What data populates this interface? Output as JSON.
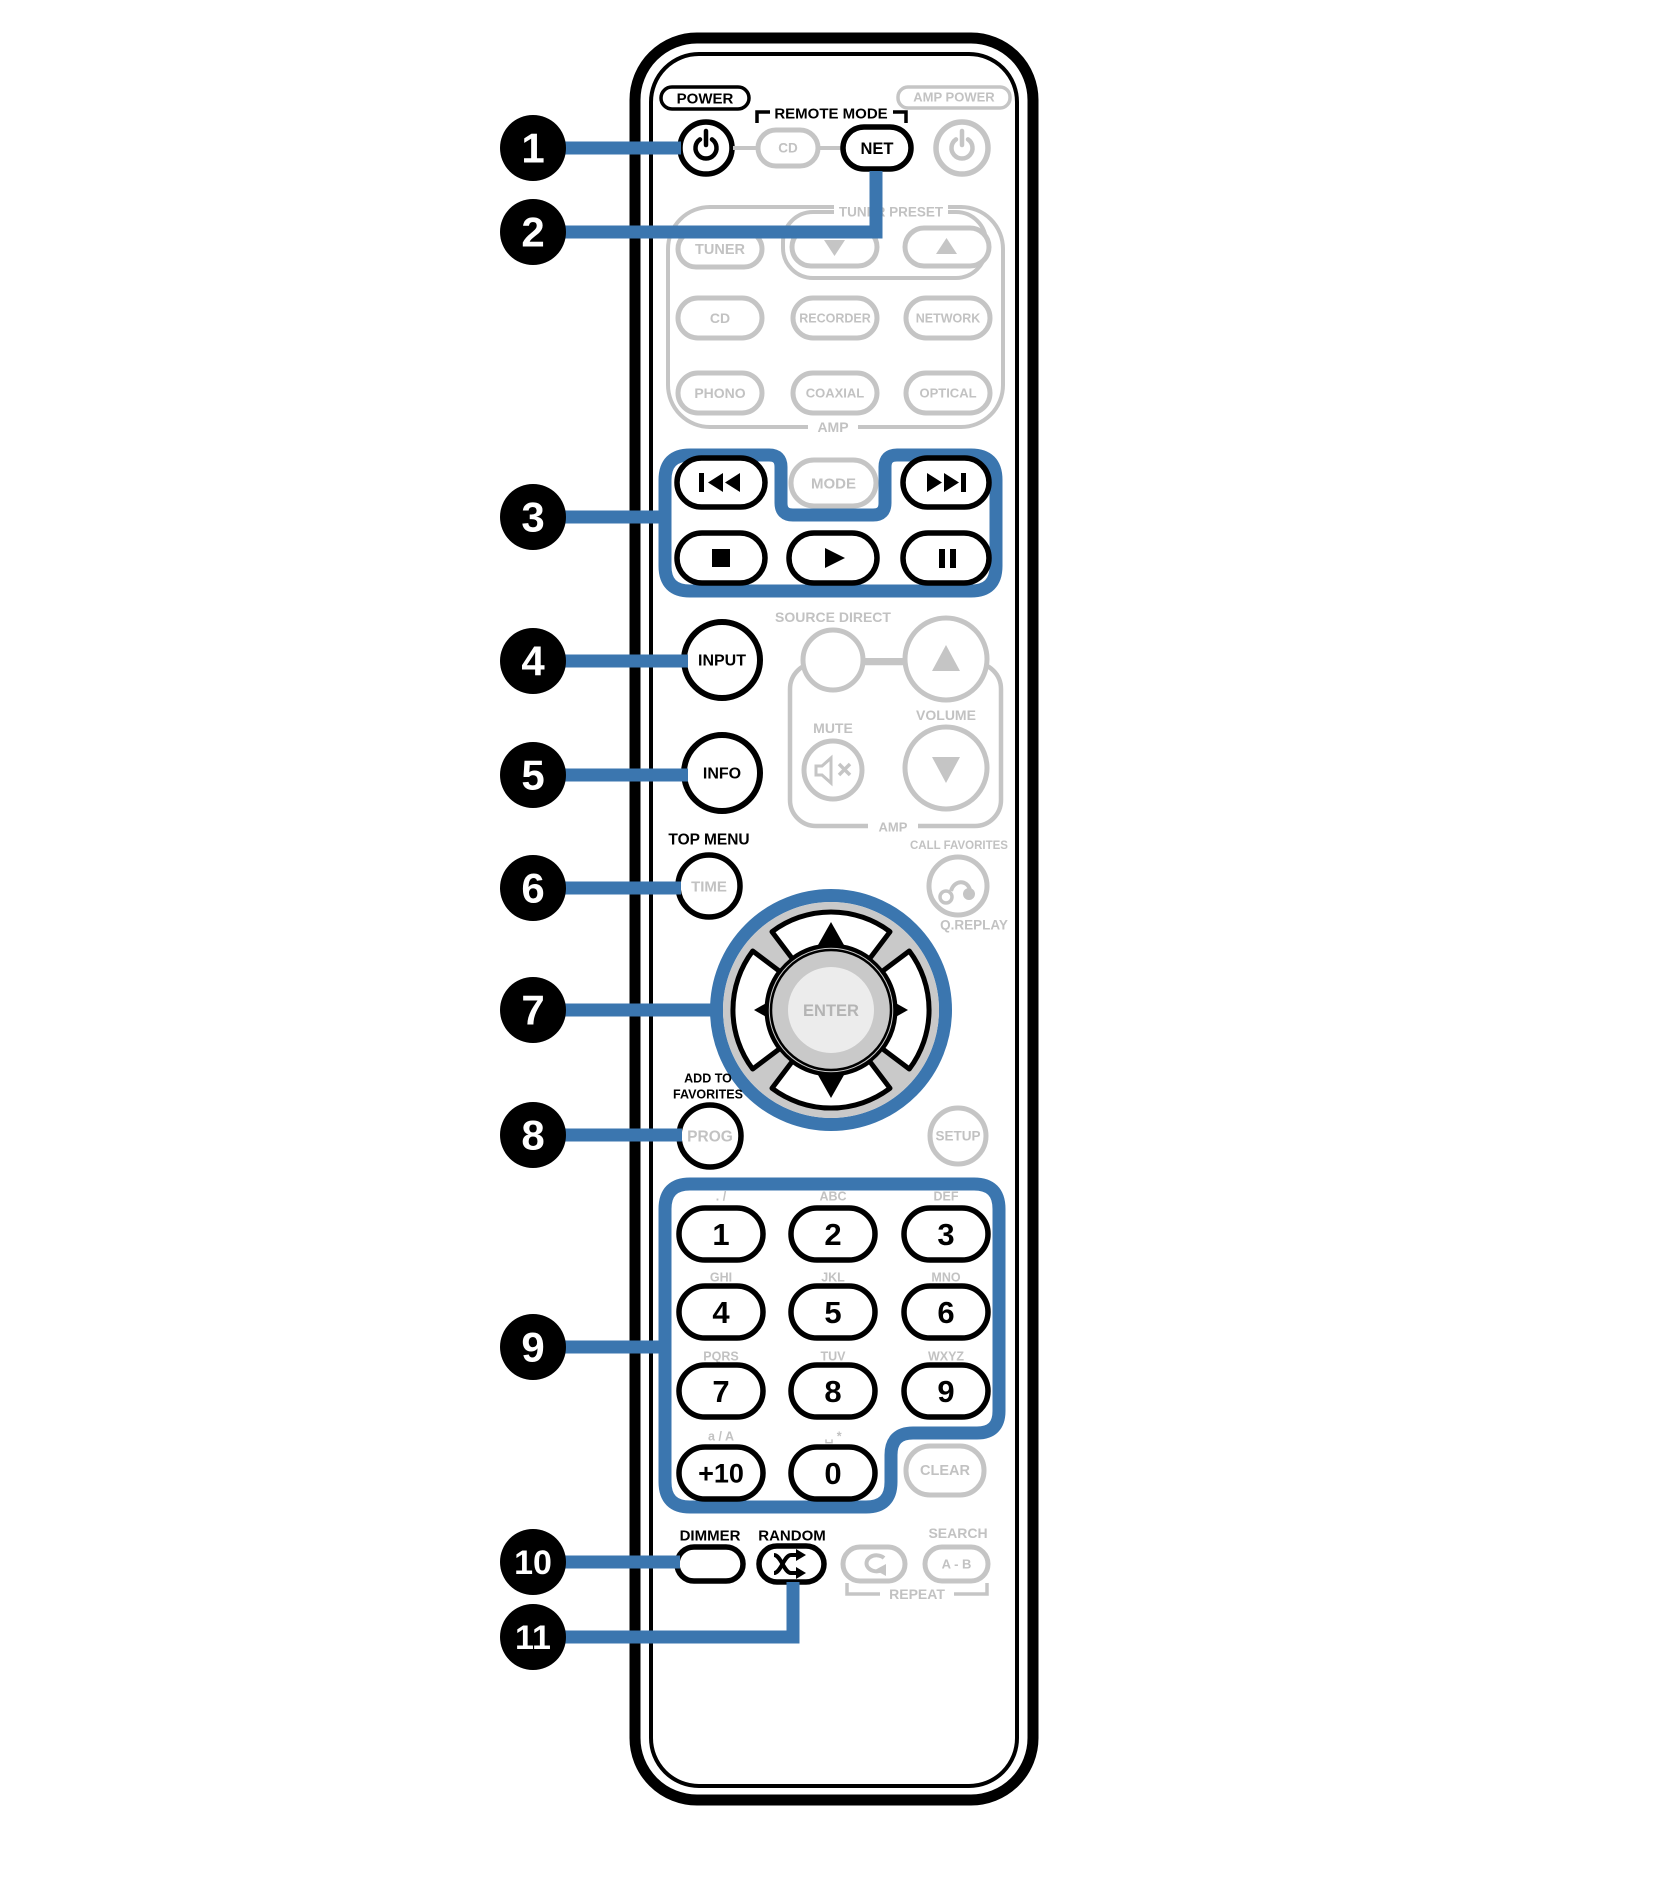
{
  "colors": {
    "callout_blue": "#3b76af",
    "inactive_gray": "#c5c5c5"
  },
  "callouts": [
    "1",
    "2",
    "3",
    "4",
    "5",
    "6",
    "7",
    "8",
    "9",
    "10",
    "11"
  ],
  "remote": {
    "power_label": "POWER",
    "remote_mode_label": "REMOTE MODE",
    "amp_power_label": "AMP POWER",
    "remote_mode_cd": "CD",
    "remote_mode_net": "NET",
    "tuner_preset_label": "TUNER PRESET",
    "tuner": "TUNER",
    "sources": [
      "CD",
      "RECORDER",
      "NETWORK",
      "PHONO",
      "COAXIAL",
      "OPTICAL"
    ],
    "amp_sources_label": "AMP",
    "mode": "MODE",
    "source_direct_label": "SOURCE DIRECT",
    "volume_label": "VOLUME",
    "mute_label": "MUTE",
    "amp_volume_label": "AMP",
    "call_favorites_label": "CALL FAVORITES",
    "q_replay_label": "Q.REPLAY",
    "input": "INPUT",
    "info": "INFO",
    "top_menu_label": "TOP MENU",
    "time": "TIME",
    "enter": "ENTER",
    "add_to_favorites_label_1": "ADD TO",
    "add_to_favorites_label_2": "FAVORITES",
    "prog": "PROG",
    "setup": "SETUP",
    "keypad": {
      "letters": [
        ". /",
        "ABC",
        "DEF",
        "GHI",
        "JKL",
        "MNO",
        "PQRS",
        "TUV",
        "WXYZ",
        "a / A",
        "␣ *"
      ],
      "digits": [
        "1",
        "2",
        "3",
        "4",
        "5",
        "6",
        "7",
        "8",
        "9",
        "+10",
        "0"
      ],
      "clear": "CLEAR"
    },
    "dimmer_label": "DIMMER",
    "random_label": "RANDOM",
    "search_label": "SEARCH",
    "ab": "A - B",
    "repeat_label": "REPEAT"
  }
}
